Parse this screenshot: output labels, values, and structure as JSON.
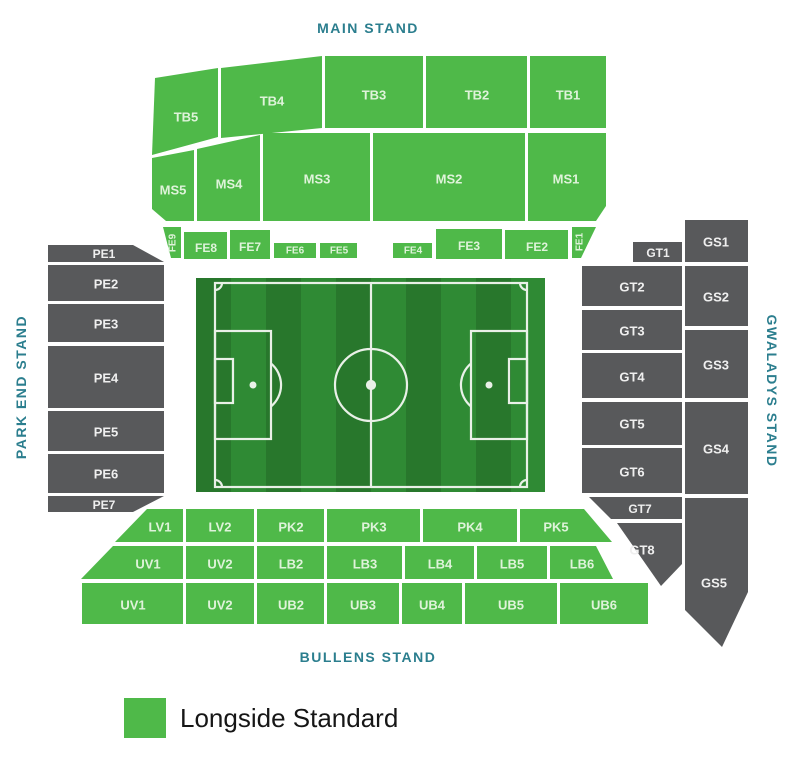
{
  "colors": {
    "green": "#4fb949",
    "gray": "#58595b",
    "stand_label": "#2b7e8e",
    "label_on_green": "#dff3da",
    "label_on_gray": "#efefef",
    "pitch_stripe_dark": "#28772c",
    "pitch_stripe_light": "#2f8a34",
    "pitch_line": "#f4f7f2"
  },
  "stand_labels": [
    {
      "id": "main-stand",
      "text": "MAIN STAND",
      "x": 368,
      "y": 28,
      "rot": 0
    },
    {
      "id": "park-end-stand",
      "text": "PARK END STAND",
      "x": 21,
      "y": 387,
      "rot": -90
    },
    {
      "id": "gwaladys-stand",
      "text": "GWALADYS STAND",
      "x": 772,
      "y": 391,
      "rot": 90
    },
    {
      "id": "bullens-stand",
      "text": "BULLENS STAND",
      "x": 368,
      "y": 657,
      "rot": 0
    }
  ],
  "sections": [
    {
      "id": "tb5",
      "label": "TB5",
      "color": "green",
      "points": "155,78 218,68 218,137 152,155",
      "lx": 186,
      "ly": 117,
      "fs": 13
    },
    {
      "id": "tb4",
      "label": "TB4",
      "color": "green",
      "points": "221,68 322,56 322,128 221,138",
      "lx": 272,
      "ly": 101,
      "fs": 13
    },
    {
      "id": "tb3",
      "label": "TB3",
      "color": "green",
      "points": "325,56 423,56 423,128 325,128",
      "lx": 374,
      "ly": 95,
      "fs": 13
    },
    {
      "id": "tb2",
      "label": "TB2",
      "color": "green",
      "points": "426,56 527,56 527,128 426,128",
      "lx": 477,
      "ly": 95,
      "fs": 13
    },
    {
      "id": "tb1",
      "label": "TB1",
      "color": "green",
      "points": "530,56 606,56 606,128 530,128",
      "lx": 568,
      "ly": 95,
      "fs": 13
    },
    {
      "id": "ms5",
      "label": "MS5",
      "color": "green",
      "points": "152,158 194,150 194,221 166,221 152,209",
      "lx": 173,
      "ly": 190,
      "fs": 13
    },
    {
      "id": "ms4",
      "label": "MS4",
      "color": "green",
      "points": "197,149 260,135 260,221 197,221",
      "lx": 229,
      "ly": 184,
      "fs": 13
    },
    {
      "id": "ms3",
      "label": "MS3",
      "color": "green",
      "points": "263,133 370,133 370,221 263,221",
      "lx": 317,
      "ly": 179,
      "fs": 13
    },
    {
      "id": "ms2",
      "label": "MS2",
      "color": "green",
      "points": "373,133 525,133 525,221 373,221",
      "lx": 449,
      "ly": 179,
      "fs": 13
    },
    {
      "id": "ms1",
      "label": "MS1",
      "color": "green",
      "points": "528,133 606,133 606,206 596,221 528,221",
      "lx": 566,
      "ly": 179,
      "fs": 13
    },
    {
      "id": "fe9",
      "label": "FE9",
      "color": "green",
      "points": "163,227 181,227 181,258 171,258",
      "lx": 173,
      "ly": 243,
      "fs": 10,
      "rot": -90
    },
    {
      "id": "fe8",
      "label": "FE8",
      "color": "green",
      "points": "184,232 227,232 227,259 184,259",
      "lx": 206,
      "ly": 248,
      "fs": 12
    },
    {
      "id": "fe7",
      "label": "FE7",
      "color": "green",
      "points": "230,230 270,230 270,259 230,259",
      "lx": 250,
      "ly": 247,
      "fs": 12
    },
    {
      "id": "fe6",
      "label": "FE6",
      "color": "green",
      "points": "274,243 316,243 316,258 274,258",
      "lx": 295,
      "ly": 251,
      "fs": 10
    },
    {
      "id": "fe5",
      "label": "FE5",
      "color": "green",
      "points": "320,243 357,243 357,258 320,258",
      "lx": 339,
      "ly": 251,
      "fs": 10
    },
    {
      "id": "fe4",
      "label": "FE4",
      "color": "green",
      "points": "393,243 432,243 432,258 393,258",
      "lx": 413,
      "ly": 251,
      "fs": 10
    },
    {
      "id": "fe3",
      "label": "FE3",
      "color": "green",
      "points": "436,229 502,229 502,259 436,259",
      "lx": 469,
      "ly": 246,
      "fs": 12
    },
    {
      "id": "fe2",
      "label": "FE2",
      "color": "green",
      "points": "505,230 568,230 568,259 505,259",
      "lx": 537,
      "ly": 247,
      "fs": 12
    },
    {
      "id": "fe1",
      "label": "FE1",
      "color": "green",
      "points": "572,227 596,227 581,258 572,258",
      "lx": 580,
      "ly": 242,
      "fs": 10,
      "rot": -90
    },
    {
      "id": "pe1",
      "label": "PE1",
      "color": "gray",
      "points": "48,245 133,245 164,262 48,262",
      "lx": 104,
      "ly": 254,
      "fs": 12
    },
    {
      "id": "pe2",
      "label": "PE2",
      "color": "gray",
      "points": "48,265 164,265 164,301 48,301",
      "lx": 106,
      "ly": 284,
      "fs": 13
    },
    {
      "id": "pe3",
      "label": "PE3",
      "color": "gray",
      "points": "48,304 164,304 164,342 48,342",
      "lx": 106,
      "ly": 324,
      "fs": 13
    },
    {
      "id": "pe4",
      "label": "PE4",
      "color": "gray",
      "points": "48,346 164,346 164,408 48,408",
      "lx": 106,
      "ly": 378,
      "fs": 13
    },
    {
      "id": "pe5",
      "label": "PE5",
      "color": "gray",
      "points": "48,411 164,411 164,451 48,451",
      "lx": 106,
      "ly": 432,
      "fs": 13
    },
    {
      "id": "pe6",
      "label": "PE6",
      "color": "gray",
      "points": "48,454 164,454 164,493 48,493",
      "lx": 106,
      "ly": 474,
      "fs": 13
    },
    {
      "id": "pe7",
      "label": "PE7",
      "color": "gray",
      "points": "48,496 164,496 133,512 48,512",
      "lx": 104,
      "ly": 505,
      "fs": 12
    },
    {
      "id": "gt1",
      "label": "GT1",
      "color": "gray",
      "points": "633,242 682,242 682,262 633,262",
      "lx": 658,
      "ly": 253,
      "fs": 12
    },
    {
      "id": "gt2",
      "label": "GT2",
      "color": "gray",
      "points": "582,266 682,266 682,306 582,306",
      "lx": 632,
      "ly": 287,
      "fs": 13
    },
    {
      "id": "gt3",
      "label": "GT3",
      "color": "gray",
      "points": "582,310 682,310 682,350 582,350",
      "lx": 632,
      "ly": 331,
      "fs": 13
    },
    {
      "id": "gt4",
      "label": "GT4",
      "color": "gray",
      "points": "582,353 682,353 682,398 582,398",
      "lx": 632,
      "ly": 377,
      "fs": 13
    },
    {
      "id": "gt5",
      "label": "GT5",
      "color": "gray",
      "points": "582,402 682,402 682,445 582,445",
      "lx": 632,
      "ly": 424,
      "fs": 13
    },
    {
      "id": "gt6",
      "label": "GT6",
      "color": "gray",
      "points": "582,448 682,448 682,493 582,493",
      "lx": 632,
      "ly": 472,
      "fs": 13
    },
    {
      "id": "gt7",
      "label": "GT7",
      "color": "gray",
      "points": "589,497 682,497 682,519 611,519",
      "lx": 640,
      "ly": 509,
      "fs": 12
    },
    {
      "id": "gt8",
      "label": "GT8",
      "color": "gray",
      "points": "617,523 682,523 682,564 661,586",
      "lx": 642,
      "ly": 550,
      "fs": 13
    },
    {
      "id": "gs1",
      "label": "GS1",
      "color": "gray",
      "points": "685,220 748,220 748,262 685,262",
      "lx": 716,
      "ly": 242,
      "fs": 13
    },
    {
      "id": "gs2",
      "label": "GS2",
      "color": "gray",
      "points": "685,266 748,266 748,326 685,326",
      "lx": 716,
      "ly": 297,
      "fs": 13
    },
    {
      "id": "gs3",
      "label": "GS3",
      "color": "gray",
      "points": "685,330 748,330 748,398 685,398",
      "lx": 716,
      "ly": 365,
      "fs": 13
    },
    {
      "id": "gs4",
      "label": "GS4",
      "color": "gray",
      "points": "685,402 748,402 748,494 685,494",
      "lx": 716,
      "ly": 449,
      "fs": 13
    },
    {
      "id": "gs5",
      "label": "GS5",
      "color": "gray",
      "points": "685,498 748,498 748,592 722,647 685,610",
      "lx": 714,
      "ly": 583,
      "fs": 13
    },
    {
      "id": "lv1",
      "label": "LV1",
      "color": "green",
      "points": "147,509 183,509 183,542 115,542",
      "lx": 160,
      "ly": 527,
      "fs": 13
    },
    {
      "id": "lv2",
      "label": "LV2",
      "color": "green",
      "points": "186,509 254,509 254,542 186,542",
      "lx": 220,
      "ly": 527,
      "fs": 13
    },
    {
      "id": "pk2",
      "label": "PK2",
      "color": "green",
      "points": "257,509 324,509 324,542 257,542",
      "lx": 291,
      "ly": 527,
      "fs": 13
    },
    {
      "id": "pk3",
      "label": "PK3",
      "color": "green",
      "points": "327,509 420,509 420,542 327,542",
      "lx": 374,
      "ly": 527,
      "fs": 13
    },
    {
      "id": "pk4",
      "label": "PK4",
      "color": "green",
      "points": "423,509 517,509 517,542 423,542",
      "lx": 470,
      "ly": 527,
      "fs": 13
    },
    {
      "id": "pk5",
      "label": "PK5",
      "color": "green",
      "points": "520,509 584,509 612,542 520,542",
      "lx": 556,
      "ly": 527,
      "fs": 13
    },
    {
      "id": "uv1-upper",
      "label": "UV1",
      "color": "green",
      "points": "113,546 183,546 183,579 81,579",
      "lx": 148,
      "ly": 564,
      "fs": 13
    },
    {
      "id": "uv2-upper",
      "label": "UV2",
      "color": "green",
      "points": "186,546 254,546 254,579 186,579",
      "lx": 220,
      "ly": 564,
      "fs": 13
    },
    {
      "id": "lb2",
      "label": "LB2",
      "color": "green",
      "points": "257,546 324,546 324,579 257,579",
      "lx": 291,
      "ly": 564,
      "fs": 13
    },
    {
      "id": "lb3",
      "label": "LB3",
      "color": "green",
      "points": "327,546 402,546 402,579 327,579",
      "lx": 365,
      "ly": 564,
      "fs": 13
    },
    {
      "id": "lb4",
      "label": "LB4",
      "color": "green",
      "points": "405,546 474,546 474,579 405,579",
      "lx": 440,
      "ly": 564,
      "fs": 13
    },
    {
      "id": "lb5",
      "label": "LB5",
      "color": "green",
      "points": "477,546 547,546 547,579 477,579",
      "lx": 512,
      "ly": 564,
      "fs": 13
    },
    {
      "id": "lb6",
      "label": "LB6",
      "color": "green",
      "points": "550,546 596,546 613,579 550,579",
      "lx": 582,
      "ly": 564,
      "fs": 13
    },
    {
      "id": "uv1-lower",
      "label": "UV1",
      "color": "green",
      "points": "82,583 183,583 183,624 82,624",
      "lx": 133,
      "ly": 605,
      "fs": 13
    },
    {
      "id": "uv2-lower",
      "label": "UV2",
      "color": "green",
      "points": "186,583 254,583 254,624 186,624",
      "lx": 220,
      "ly": 605,
      "fs": 13
    },
    {
      "id": "ub2",
      "label": "UB2",
      "color": "green",
      "points": "257,583 324,583 324,624 257,624",
      "lx": 291,
      "ly": 605,
      "fs": 13
    },
    {
      "id": "ub3",
      "label": "UB3",
      "color": "green",
      "points": "327,583 399,583 399,624 327,624",
      "lx": 363,
      "ly": 605,
      "fs": 13
    },
    {
      "id": "ub4",
      "label": "UB4",
      "color": "green",
      "points": "402,583 462,583 462,624 402,624",
      "lx": 432,
      "ly": 605,
      "fs": 13
    },
    {
      "id": "ub5",
      "label": "UB5",
      "color": "green",
      "points": "465,583 557,583 557,624 465,624",
      "lx": 511,
      "ly": 605,
      "fs": 13
    },
    {
      "id": "ub6",
      "label": "UB6",
      "color": "green",
      "points": "560,583 648,583 648,624 560,624",
      "lx": 604,
      "ly": 605,
      "fs": 13
    }
  ],
  "legend": {
    "swatch_color": "#4fb949",
    "label": "Longside Standard"
  }
}
